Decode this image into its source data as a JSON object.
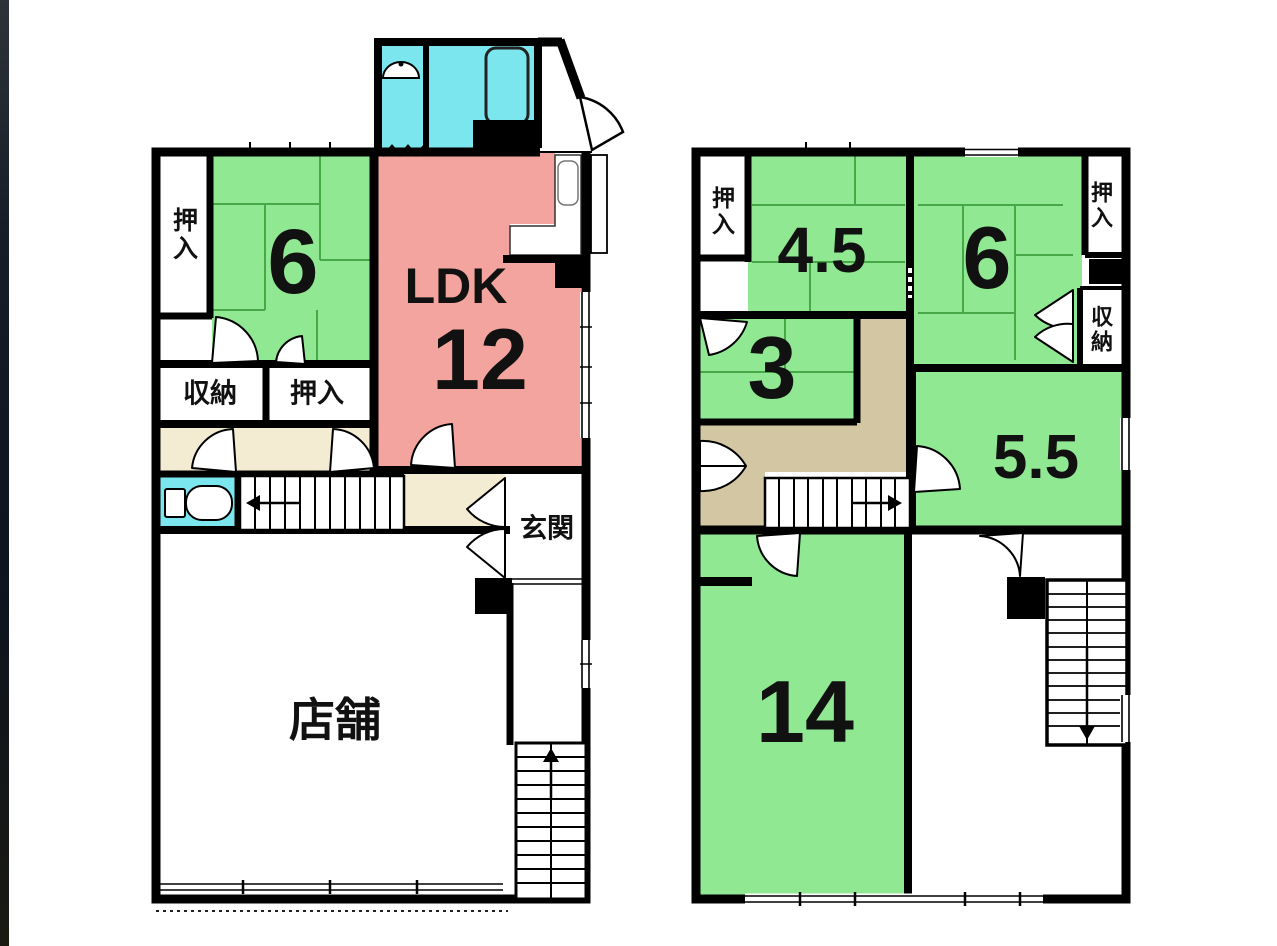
{
  "palette": {
    "tatami_green": "#90e892",
    "tatami_grid_line": "#46a846",
    "ldk_pink": "#f3a49e",
    "water_cyan": "#7ce6ee",
    "hall_cream_1f": "#f3ecd3",
    "hall_tan_2f": "#d3c6a3",
    "wall_black": "#000000",
    "left_edge_bar": "#161d28",
    "background": "#ffffff"
  },
  "left_plan": {
    "closet_top_left": "押入",
    "tatami_6": "6",
    "ldk_label": "LDK",
    "ldk_size": "12",
    "storage": "収納",
    "closet_mid": "押入",
    "entrance": "玄関",
    "shop": "店舗"
  },
  "right_plan": {
    "closet_top_left": "押入",
    "tatami_4_5": "4.5",
    "tatami_6": "6",
    "closet_top_right": "押入",
    "storage": "収納",
    "tatami_3": "3",
    "tatami_5_5": "5.5",
    "tatami_14": "14"
  }
}
